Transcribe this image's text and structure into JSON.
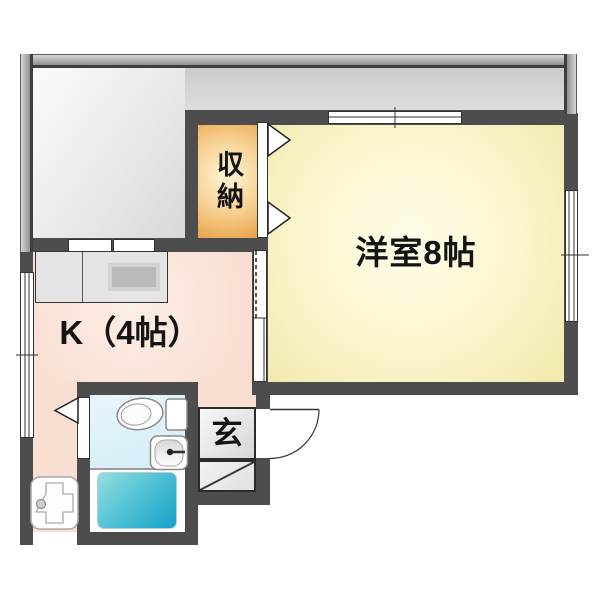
{
  "floor_plan": {
    "rooms": {
      "western_room": {
        "label": "洋室8帖",
        "fill": "#faf4c6"
      },
      "kitchen": {
        "label": "K（4帖）",
        "fill": "#f9ddd0"
      },
      "closet": {
        "label": "収納",
        "fill": "#f2bd74"
      },
      "entrance": {
        "label": "玄",
        "fill": "#e8e8e8"
      }
    },
    "fixtures": [
      "toilet",
      "washbasin",
      "bathtub",
      "kitchen-counter",
      "stove",
      "sink-unit",
      "entrance-door",
      "bifold-closet-door",
      "bifold-bath-door",
      "sliding-door",
      "windows"
    ],
    "colors": {
      "wall": "#4d4d4d",
      "balcony_fill": "#e0e0e0",
      "bath_floor": "#ddf0f9",
      "bathtub": "#2fb0cd"
    }
  }
}
